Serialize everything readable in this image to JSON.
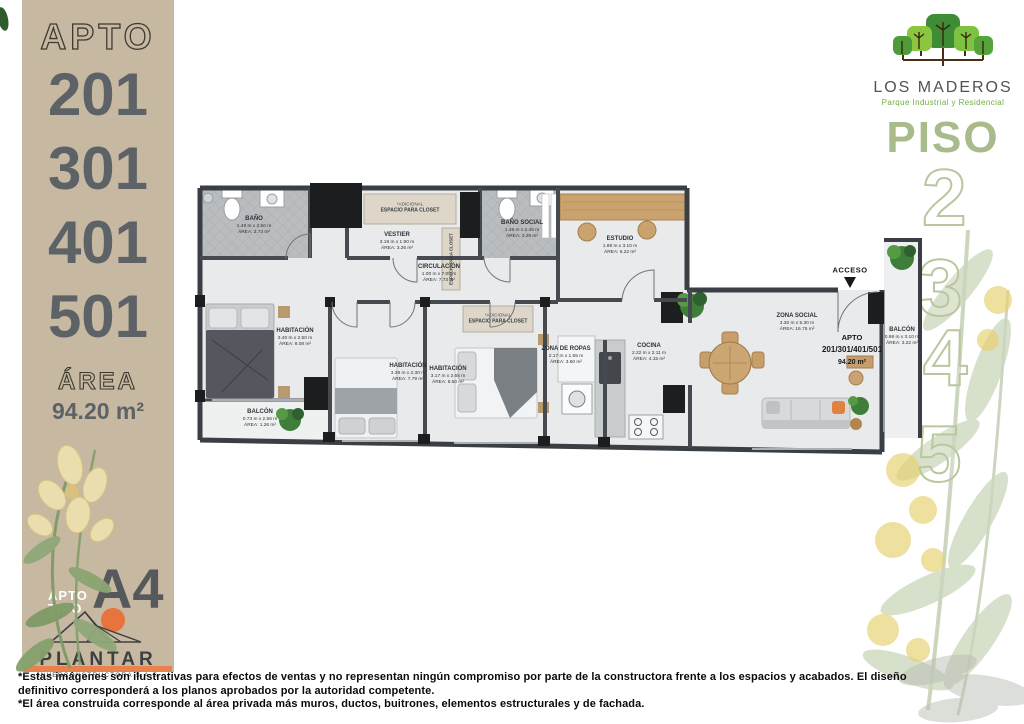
{
  "sidebar": {
    "apto_label": "APTO",
    "units": [
      "201",
      "301",
      "401",
      "501"
    ],
    "area_label": "ÁREA",
    "area_value": "94.20 m²",
    "tipo": {
      "line1": "APTO",
      "line2": "TIPO",
      "value": "A4"
    },
    "brand": {
      "name": "PLANTAR",
      "subtitle": "INVERCONSTRUCTORA S.A.S"
    }
  },
  "header": {
    "project_name": "LOS MADEROS",
    "project_subtitle": "Parque Industrial y Residencial",
    "piso_label": "PISO",
    "floors": [
      "2",
      "3",
      "4",
      "5"
    ]
  },
  "floorplan": {
    "acceso_label": "ACCESO",
    "apto_tag": {
      "line1": "APTO",
      "line2": "201/301/401/501",
      "line3": "94.20 m²"
    },
    "closet_note": "*ADICIONAL",
    "closet_label": "ESPACIO PARA CLOSET",
    "rooms": [
      {
        "name": "BAÑO",
        "dims": "1.49 m x 2.50 m",
        "area": "ÁREA: 3.73 m²"
      },
      {
        "name": "VESTIER",
        "dims": "3.19 m x 1.90 m",
        "area": "ÁREA: 3.26 m²"
      },
      {
        "name": "BAÑO SOCIAL",
        "dims": "1.48 m x 2.45 m",
        "area": "ÁREA: 3.29 m²"
      },
      {
        "name": "ESTUDIO",
        "dims": "1.98 m x 3.10 m",
        "area": "ÁREA: 6.22 m²"
      },
      {
        "name": "CIRCULACIÓN",
        "dims": "1.00 m x 7.05 m",
        "area": "ÁREA: 7.73 m²"
      },
      {
        "name": "HABITACIÓN",
        "dims": "3.40 m x 2.50 m",
        "area": "ÁREA: 8.08 m²"
      },
      {
        "name": "BALCÓN",
        "dims": "0.73 m x 2.56 m",
        "area": "ÁREA: 1.26 m²"
      },
      {
        "name": "HABITACIÓN",
        "dims": "3.39 m x 2.30 m",
        "area": "ÁREA: 7.79 m²"
      },
      {
        "name": "HABITACIÓN",
        "dims": "3.17 m x 2.65 m",
        "area": "ÁREA: 8.50 m²"
      },
      {
        "name": "ZONA DE ROPAS",
        "dims": "2.17 m x 1.55 m",
        "area": "ÁREA: 3.60 m²"
      },
      {
        "name": "COCINA",
        "dims": "2.22 m x 2.11 m",
        "area": "ÁREA: 4.15 m²"
      },
      {
        "name": "ZONA SOCIAL",
        "dims": "3.30 m x 5.30 m",
        "area": "ÁREA: 16.75 m²"
      },
      {
        "name": "BALCÓN",
        "dims": "0.98 m x 3.10 m",
        "area": "ÁREA: 3.22 m²"
      }
    ]
  },
  "footer": {
    "lines": [
      "*Estas imágenes son ilustrativas para efectos de ventas y no representan ningún compromiso por parte de la constructora frente a los espacios y acabados. El diseño",
      "definitivo corresponderá a los planos aprobados por la autoridad competente.",
      "*El área construida corresponde al área privada más muros, ductos, buitrones, elementos estructurales y de fachada."
    ]
  },
  "colors": {
    "sidebar_beige": "#c7b8a2",
    "number_gray": "#5c6266",
    "sage_green": "#a9ba8b",
    "logo_green": "#6fae3f",
    "brand_orange": "#e8814b",
    "wall_dark": "#3a3f45"
  }
}
